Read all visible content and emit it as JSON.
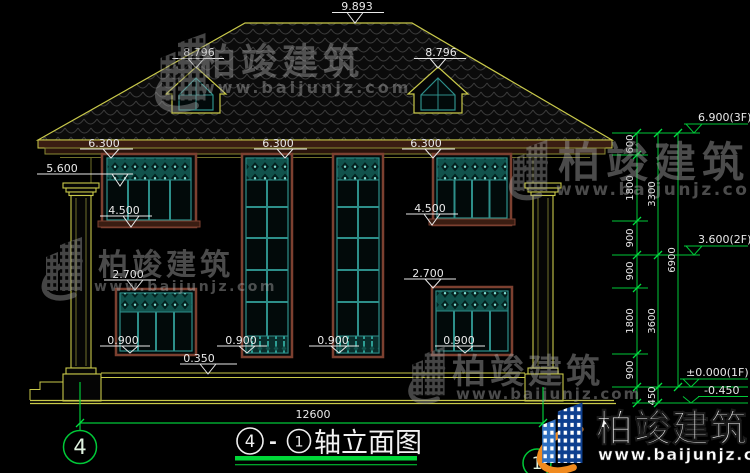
{
  "watermark": {
    "brand": "柏竣建筑",
    "url": "www.baijunjz.com"
  },
  "markers": {
    "ridge": "9.893",
    "dormers": [
      "8.796",
      "8.796"
    ],
    "eave": [
      "6.300",
      "6.300",
      "6.300"
    ],
    "capital": "5.600",
    "sill2f": [
      "4.500",
      "4.500"
    ],
    "head1f": [
      "2.700",
      "2.700"
    ],
    "sill1f": [
      "0.900",
      "0.900",
      "0.900",
      "0.900"
    ],
    "plinth": "0.350"
  },
  "levels": {
    "f3": "6.900(3F)",
    "f2": "3.600(2F)",
    "f1": "±0.000(1F)",
    "ground": "-0.450"
  },
  "chain": {
    "segments": [
      "600",
      "1800",
      "900",
      "900",
      "1800",
      "900"
    ],
    "subtotals": [
      "3300",
      "3600",
      "450"
    ],
    "total": "6900"
  },
  "bottom": {
    "overall_width": "12600",
    "axis_left": "4",
    "axis_right": "1"
  },
  "title": {
    "axis_start": "4",
    "separator": "-",
    "axis_end": "1",
    "text": "轴立面图"
  }
}
